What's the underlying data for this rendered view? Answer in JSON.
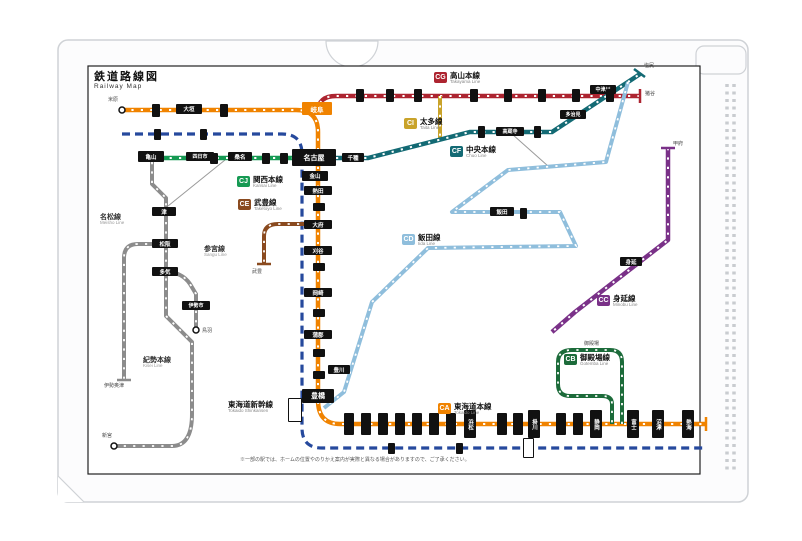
{
  "page": {
    "title_jp": "鉄道路線図",
    "title_en": "Railway Map",
    "note": "※一部の駅では、ホームの位置やのりかえ案内が実際と異なる場合がありますので、ご了承ください。",
    "colors": {
      "file_edge": "#cfd2d6",
      "map_border": "#222222",
      "paper": "#fcfcfd"
    }
  },
  "lines": [
    {
      "id": "tokaido",
      "code": "CA",
      "name_jp": "東海道本線",
      "name_en": "Tokaido Line",
      "color": "#f08300",
      "badge": {
        "x": 438,
        "y": 403
      }
    },
    {
      "id": "gotemba",
      "code": "CB",
      "name_jp": "御殿場線",
      "name_en": "Gotemba Line",
      "color": "#1c6b3a",
      "badge": {
        "x": 564,
        "y": 354
      }
    },
    {
      "id": "minobu",
      "code": "CC",
      "name_jp": "身延線",
      "name_en": "Minobu Line",
      "color": "#7a3188",
      "badge": {
        "x": 597,
        "y": 295
      }
    },
    {
      "id": "iida",
      "code": "CD",
      "name_jp": "飯田線",
      "name_en": "Iida Line",
      "color": "#8fbedc",
      "badge": {
        "x": 402,
        "y": 234
      }
    },
    {
      "id": "taketoyo",
      "code": "CE",
      "name_jp": "武豊線",
      "name_en": "Taketoyo Line",
      "color": "#8a4a1f",
      "badge": {
        "x": 238,
        "y": 199
      }
    },
    {
      "id": "chuo",
      "code": "CF",
      "name_jp": "中央本線",
      "name_en": "Chuo Line",
      "color": "#136a74",
      "badge": {
        "x": 450,
        "y": 146
      }
    },
    {
      "id": "takayama",
      "code": "CG",
      "name_jp": "高山本線",
      "name_en": "Takayama Line",
      "color": "#ad2430",
      "badge": {
        "x": 434,
        "y": 72
      }
    },
    {
      "id": "taita",
      "code": "CI",
      "name_jp": "太多線",
      "name_en": "Taita Line",
      "color": "#c9a32a",
      "badge": {
        "x": 404,
        "y": 118
      }
    },
    {
      "id": "kansai",
      "code": "CJ",
      "name_jp": "関西本線",
      "name_en": "Kansai Line",
      "color": "#169a53",
      "badge": {
        "x": 237,
        "y": 176
      }
    },
    {
      "id": "shinkansen",
      "code": "",
      "name_jp": "東海道新幹線",
      "name_en": "Tokaido Shinkansen",
      "color": "#26499d",
      "badge": {
        "x": 228,
        "y": 401
      }
    }
  ],
  "gray_lines": [
    {
      "name_jp": "名松線",
      "name_en": "Meisho Line",
      "x": 100,
      "y": 214
    },
    {
      "name_jp": "参宮線",
      "name_en": "Sangu Line",
      "x": 204,
      "y": 246
    },
    {
      "name_jp": "紀勢本線",
      "name_en": "Kisei Line",
      "x": 143,
      "y": 357
    }
  ],
  "stations": {
    "major": [
      {
        "t": "名古屋",
        "x": 292,
        "y": 149,
        "w": 44,
        "h": 17,
        "fs": 7
      },
      {
        "t": "金山",
        "x": 302,
        "y": 171,
        "w": 26,
        "h": 10
      },
      {
        "t": "岐阜",
        "x": 302,
        "y": 102,
        "w": 30,
        "h": 13,
        "fs": 6.5,
        "fill": "#f08300"
      },
      {
        "t": "大垣",
        "x": 176,
        "y": 104,
        "w": 26,
        "h": 10
      },
      {
        "t": "千種",
        "x": 342,
        "y": 153,
        "w": 22,
        "h": 9
      },
      {
        "t": "高蔵寺",
        "x": 496,
        "y": 127,
        "w": 28,
        "h": 9,
        "fs": 5
      },
      {
        "t": "多治見",
        "x": 560,
        "y": 110,
        "w": 26,
        "h": 9,
        "fs": 5
      },
      {
        "t": "中津川",
        "x": 590,
        "y": 85,
        "w": 26,
        "h": 9,
        "fs": 5
      },
      {
        "t": "熱田",
        "x": 304,
        "y": 186,
        "w": 28,
        "h": 9
      },
      {
        "t": "大府",
        "x": 304,
        "y": 220,
        "w": 28,
        "h": 9
      },
      {
        "t": "刈谷",
        "x": 304,
        "y": 246,
        "w": 28,
        "h": 9
      },
      {
        "t": "岡崎",
        "x": 304,
        "y": 288,
        "w": 28,
        "h": 9
      },
      {
        "t": "蒲郡",
        "x": 304,
        "y": 330,
        "w": 28,
        "h": 9
      },
      {
        "t": "豊橋",
        "x": 302,
        "y": 389,
        "w": 32,
        "h": 14,
        "fs": 7
      },
      {
        "t": "亀山",
        "x": 138,
        "y": 151,
        "w": 26,
        "h": 11
      },
      {
        "t": "四日市",
        "x": 186,
        "y": 152,
        "w": 28,
        "h": 9,
        "fs": 5
      },
      {
        "t": "桑名",
        "x": 228,
        "y": 152,
        "w": 24,
        "h": 9
      },
      {
        "t": "津",
        "x": 152,
        "y": 207,
        "w": 24,
        "h": 9
      },
      {
        "t": "松阪",
        "x": 152,
        "y": 239,
        "w": 26,
        "h": 9
      },
      {
        "t": "多気",
        "x": 152,
        "y": 267,
        "w": 26,
        "h": 9
      },
      {
        "t": "伊勢市",
        "x": 182,
        "y": 301,
        "w": 28,
        "h": 9,
        "fs": 5
      },
      {
        "t": "飯田",
        "x": 490,
        "y": 207,
        "w": 24,
        "h": 9
      },
      {
        "t": "豊川",
        "x": 328,
        "y": 365,
        "w": 22,
        "h": 9
      },
      {
        "t": "身延",
        "x": 620,
        "y": 257,
        "w": 22,
        "h": 9
      },
      {
        "t": "浜松",
        "x": 464,
        "y": 410,
        "w": 12,
        "h": 28,
        "v": 1
      },
      {
        "t": "掛川",
        "x": 528,
        "y": 410,
        "w": 12,
        "h": 28,
        "v": 1
      },
      {
        "t": "静岡",
        "x": 590,
        "y": 410,
        "w": 12,
        "h": 28,
        "v": 1
      },
      {
        "t": "富士",
        "x": 627,
        "y": 410,
        "w": 12,
        "h": 28,
        "v": 1
      },
      {
        "t": "沼津",
        "x": 652,
        "y": 410,
        "w": 12,
        "h": 28,
        "v": 1
      },
      {
        "t": "熱海",
        "x": 682,
        "y": 410,
        "w": 12,
        "h": 28,
        "v": 1
      }
    ],
    "minor": [
      {
        "x": 356,
        "y": 89,
        "w": 8,
        "h": 13
      },
      {
        "x": 386,
        "y": 89,
        "w": 8,
        "h": 13
      },
      {
        "x": 414,
        "y": 89,
        "w": 8,
        "h": 13
      },
      {
        "x": 470,
        "y": 89,
        "w": 8,
        "h": 13
      },
      {
        "x": 504,
        "y": 89,
        "w": 8,
        "h": 13
      },
      {
        "x": 538,
        "y": 89,
        "w": 8,
        "h": 13
      },
      {
        "x": 572,
        "y": 89,
        "w": 8,
        "h": 13
      },
      {
        "x": 606,
        "y": 89,
        "w": 8,
        "h": 13
      },
      {
        "x": 152,
        "y": 104,
        "w": 8,
        "h": 13
      },
      {
        "x": 220,
        "y": 104,
        "w": 8,
        "h": 13
      },
      {
        "x": 154,
        "y": 129,
        "w": 7,
        "h": 11
      },
      {
        "x": 200,
        "y": 129,
        "w": 7,
        "h": 11
      },
      {
        "x": 313,
        "y": 203,
        "w": 12,
        "h": 8
      },
      {
        "x": 313,
        "y": 263,
        "w": 12,
        "h": 8
      },
      {
        "x": 313,
        "y": 309,
        "w": 12,
        "h": 8
      },
      {
        "x": 313,
        "y": 349,
        "w": 12,
        "h": 8
      },
      {
        "x": 313,
        "y": 371,
        "w": 12,
        "h": 8
      },
      {
        "x": 210,
        "y": 153,
        "w": 8,
        "h": 11
      },
      {
        "x": 262,
        "y": 153,
        "w": 8,
        "h": 11
      },
      {
        "x": 280,
        "y": 153,
        "w": 8,
        "h": 11
      },
      {
        "x": 478,
        "y": 126,
        "w": 7,
        "h": 12
      },
      {
        "x": 534,
        "y": 126,
        "w": 7,
        "h": 12
      },
      {
        "x": 344,
        "y": 413,
        "w": 10,
        "h": 22
      },
      {
        "x": 361,
        "y": 413,
        "w": 10,
        "h": 22
      },
      {
        "x": 378,
        "y": 413,
        "w": 10,
        "h": 22
      },
      {
        "x": 395,
        "y": 413,
        "w": 10,
        "h": 22
      },
      {
        "x": 412,
        "y": 413,
        "w": 10,
        "h": 22
      },
      {
        "x": 429,
        "y": 413,
        "w": 10,
        "h": 22
      },
      {
        "x": 446,
        "y": 413,
        "w": 10,
        "h": 22
      },
      {
        "x": 497,
        "y": 413,
        "w": 10,
        "h": 22
      },
      {
        "x": 513,
        "y": 413,
        "w": 10,
        "h": 22
      },
      {
        "x": 556,
        "y": 413,
        "w": 10,
        "h": 22
      },
      {
        "x": 573,
        "y": 413,
        "w": 10,
        "h": 22
      },
      {
        "x": 388,
        "y": 443,
        "w": 7,
        "h": 11
      },
      {
        "x": 456,
        "y": 443,
        "w": 7,
        "h": 11
      },
      {
        "x": 520,
        "y": 208,
        "w": 7,
        "h": 11
      }
    ],
    "white_boxes": [
      {
        "x": 288,
        "y": 398,
        "w": 14,
        "h": 24
      },
      {
        "x": 523,
        "y": 438,
        "w": 11,
        "h": 20
      }
    ],
    "termini_labels": [
      {
        "t": "米原",
        "x": 108,
        "y": 96
      },
      {
        "t": "猪谷",
        "x": 645,
        "y": 90
      },
      {
        "t": "塩尻",
        "x": 644,
        "y": 62
      },
      {
        "t": "甲府",
        "x": 673,
        "y": 140
      },
      {
        "t": "武豊",
        "x": 252,
        "y": 268
      },
      {
        "t": "伊勢奥津",
        "x": 104,
        "y": 382
      },
      {
        "t": "鳥羽",
        "x": 202,
        "y": 327
      },
      {
        "t": "新宮",
        "x": 102,
        "y": 432
      },
      {
        "t": "御殿場",
        "x": 584,
        "y": 340
      }
    ]
  }
}
